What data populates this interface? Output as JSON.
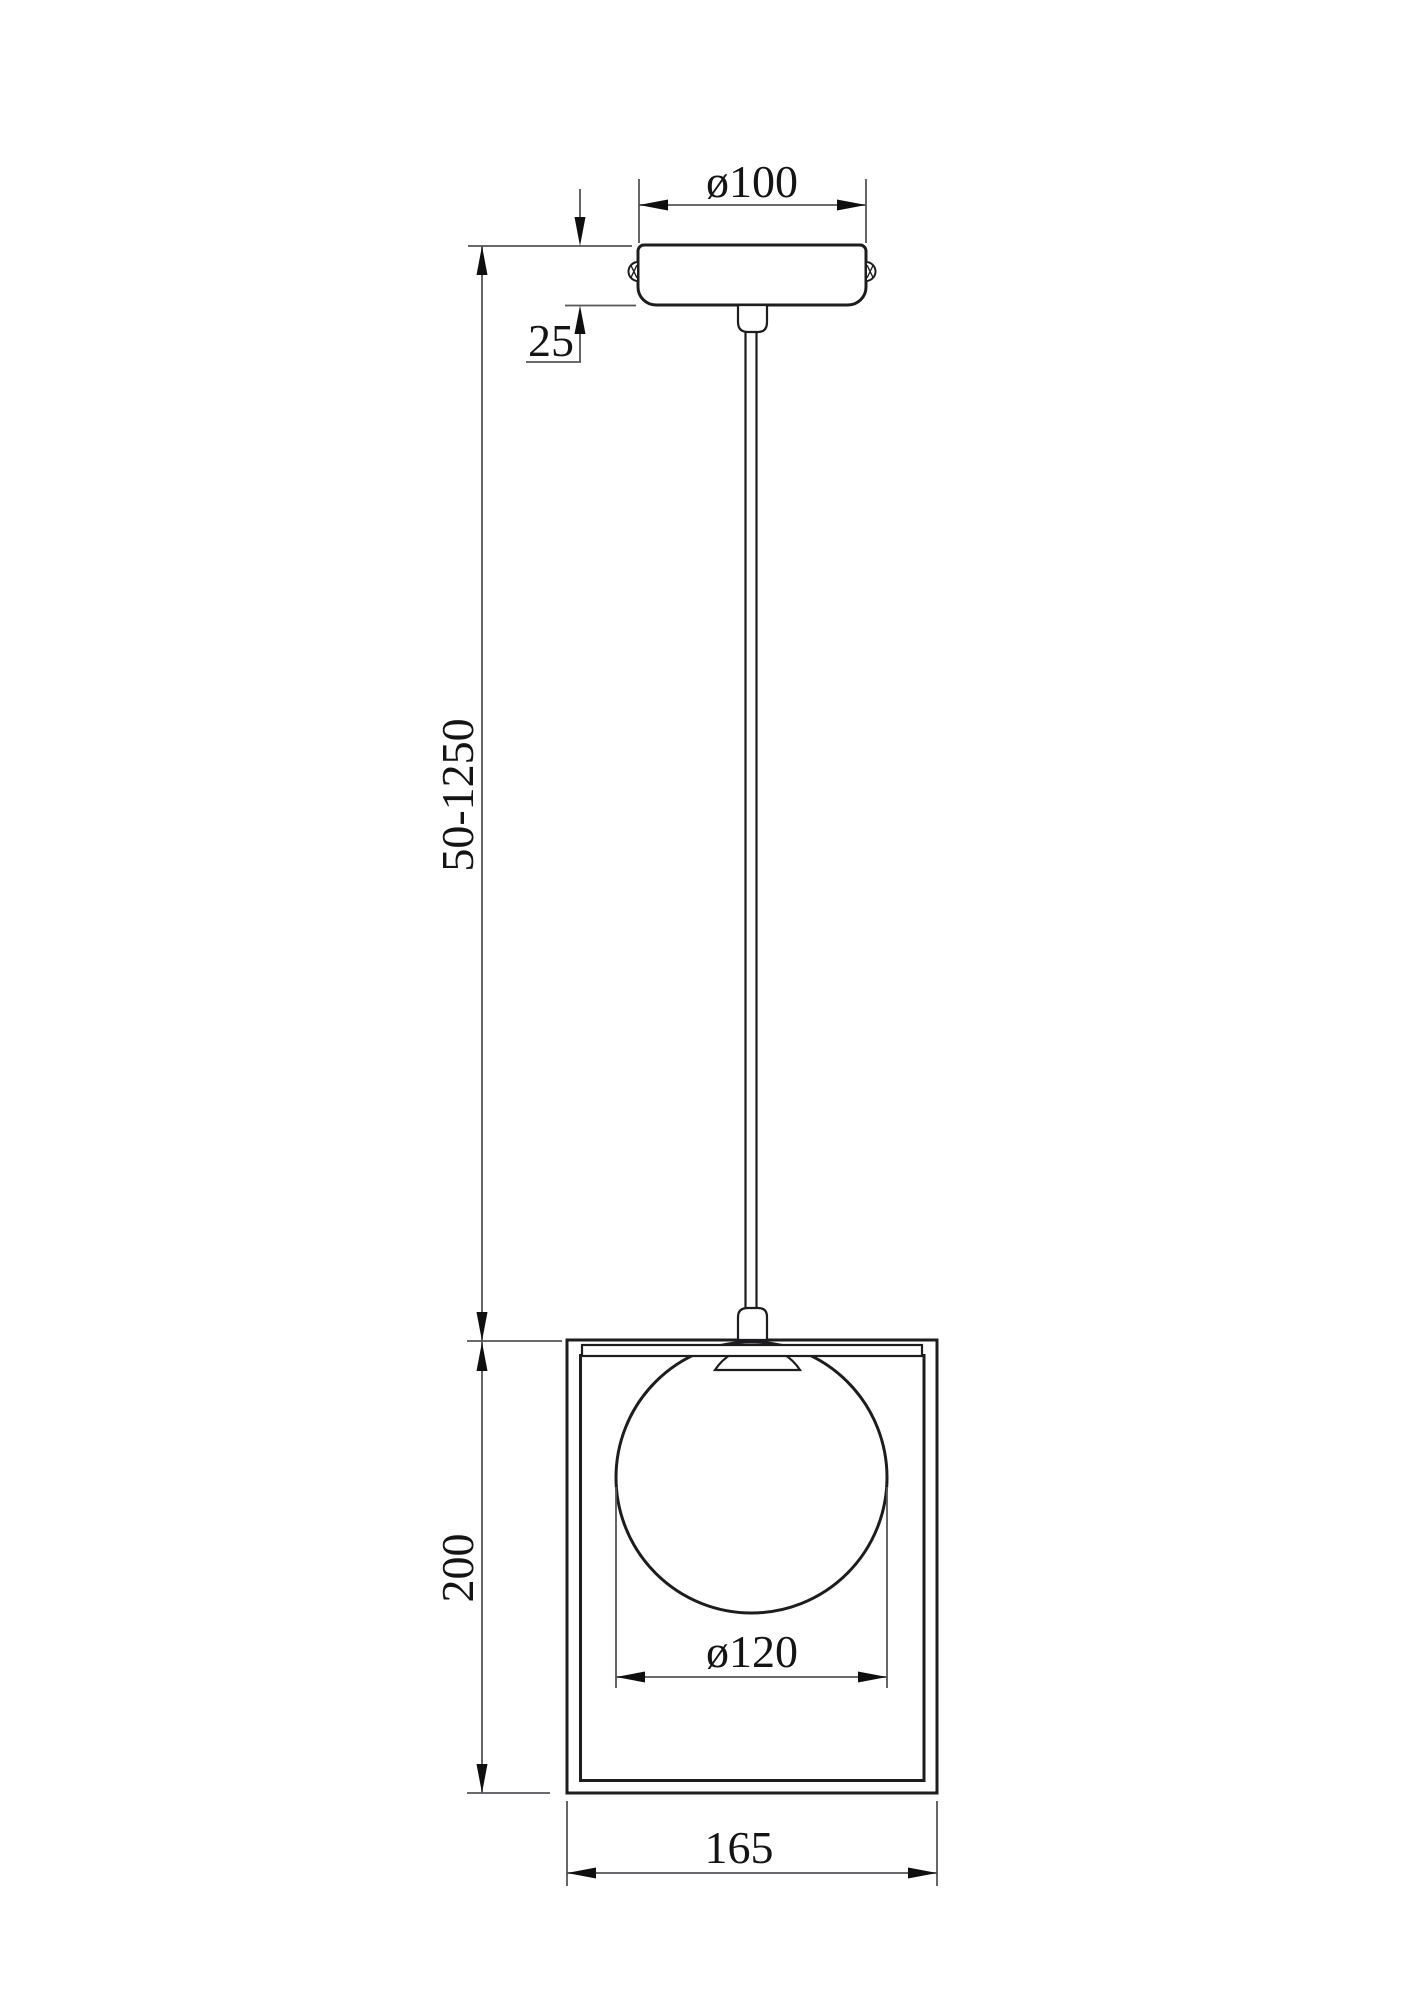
{
  "colors": {
    "background": "#ffffff",
    "object_line": "#1d1d1f",
    "dimension_line": "#55565a",
    "arrow": "#0f0f10",
    "text": "#141414"
  },
  "dimensions": {
    "canopy_diameter": "ø100",
    "canopy_height": "25",
    "suspension_length": "50-1250",
    "frame_height": "200",
    "globe_diameter": "ø120",
    "frame_width": "165"
  }
}
